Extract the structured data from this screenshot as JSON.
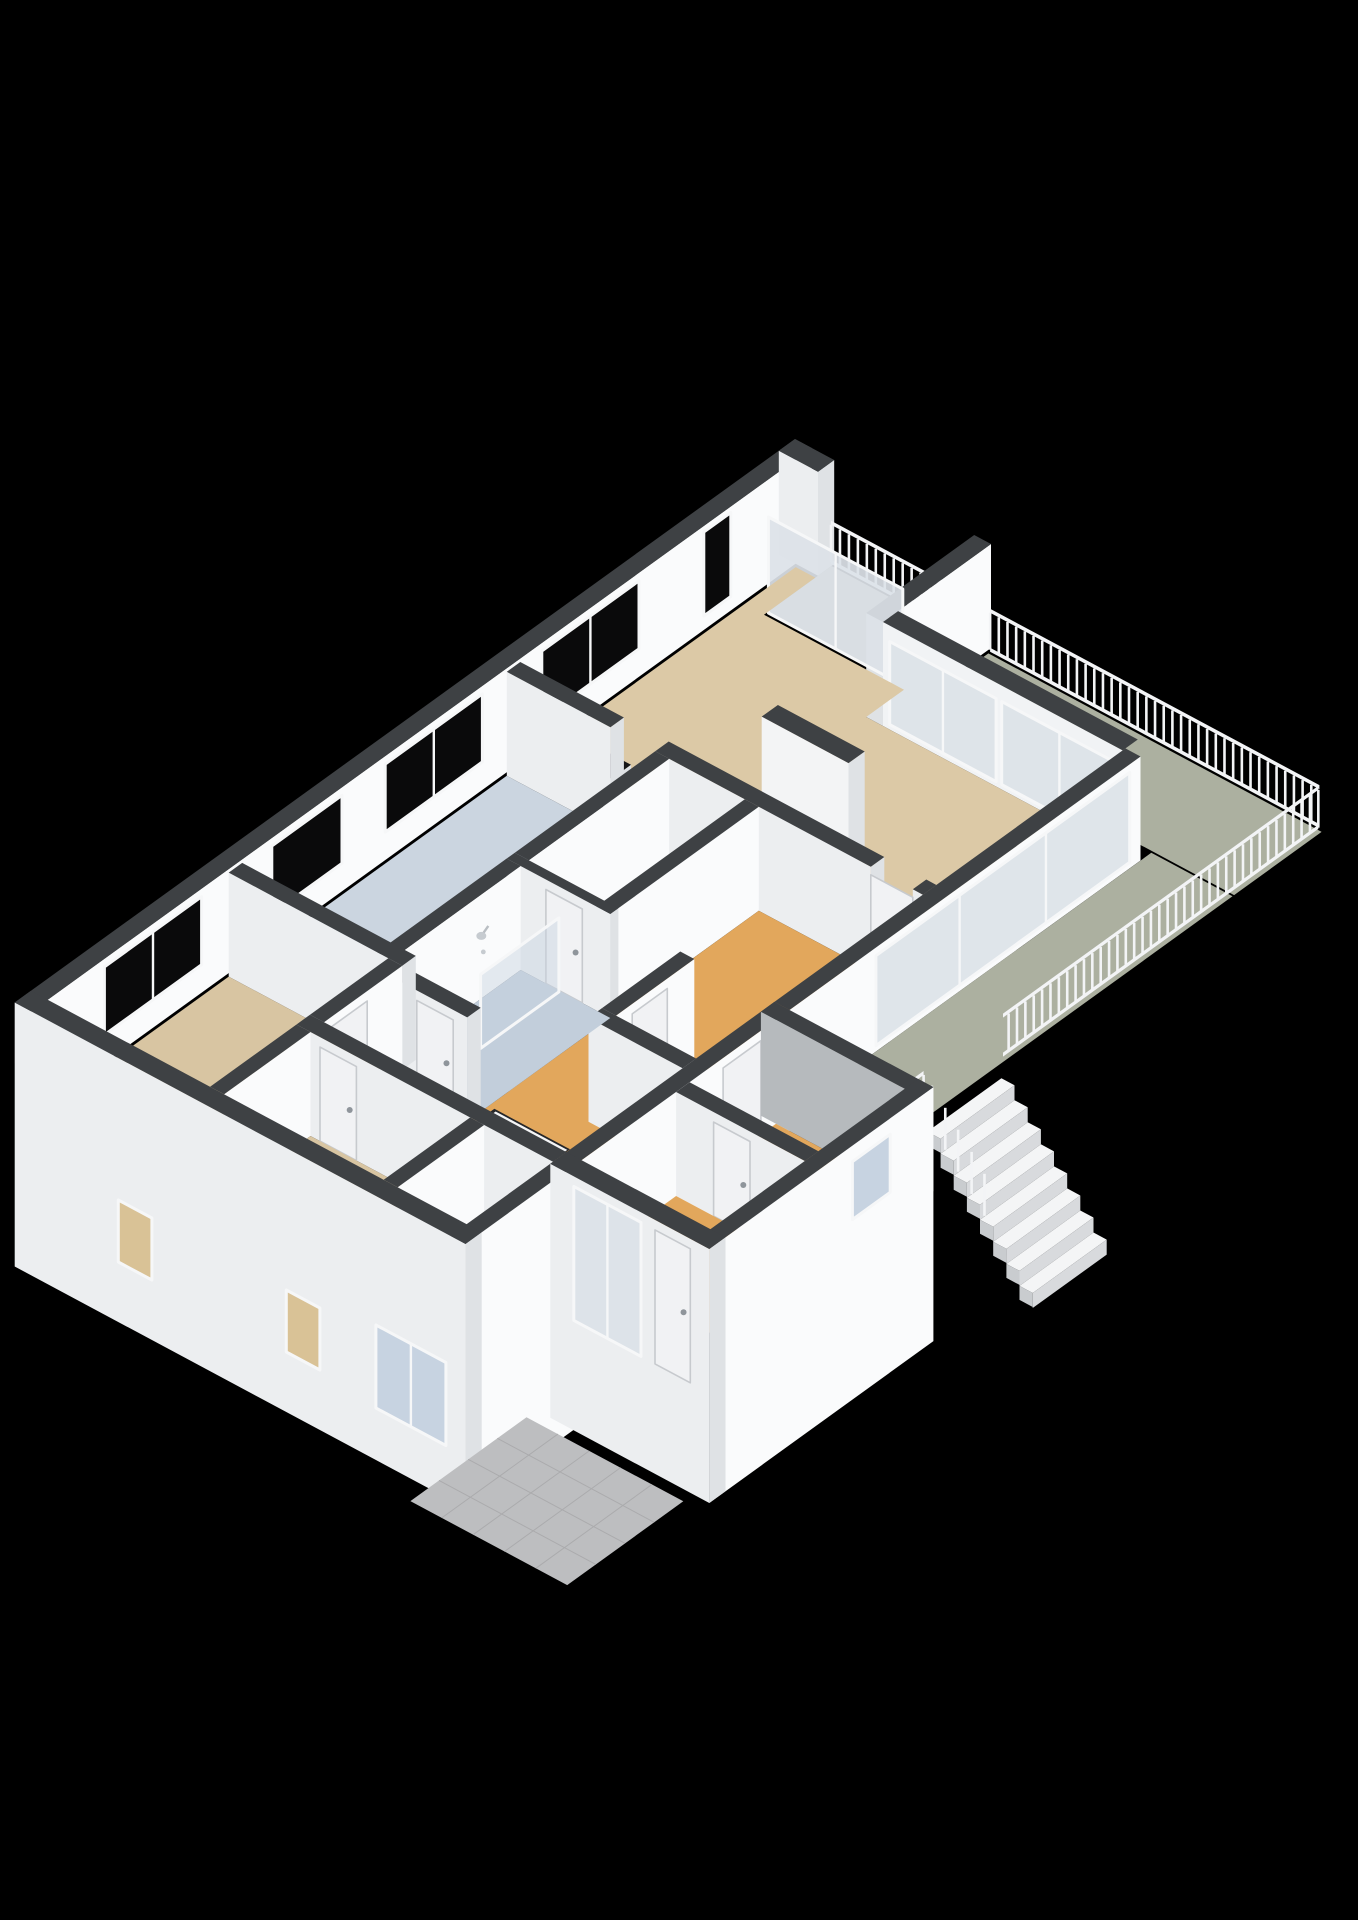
{
  "view": {
    "title": "3d-floorplan-isometric-view",
    "canvas": {
      "width": 1358,
      "height": 1920,
      "background": "#000000"
    }
  },
  "projection": {
    "ox": 795,
    "oy": 543,
    "ux": 56,
    "uy": 30,
    "vx": -54,
    "vy": 39,
    "wallH": 104,
    "railH": 47
  },
  "palette": {
    "wallTop": "#3e4144",
    "faceSE": "#fafbfc",
    "faceSW": "#eceef0",
    "cap": "#dfe2e5",
    "faceGray": "#b6babd",
    "frame": "#f6f7f8",
    "glassDark": "#0a0a0b",
    "glassPale": "#dce2e8",
    "glassFrost": "#c7d3e1",
    "glassLit": "#d9c296",
    "floorTan": "#dcc9a6",
    "floorTan2": "#d8c5a2",
    "floorOrange": "#e2a75c",
    "floorBlue": "#cbd5e0",
    "floorBath": "#c2cedb",
    "floorPale": "#e8e9eb",
    "floorToilet": "#e2e6ea",
    "terrace": "#acb0a0",
    "balcony": "#b1b5a5",
    "porch": "#bdbec0",
    "porchLine": "#ababad",
    "counterTop": "#161617",
    "cabinet": "#f2f3f4",
    "hob": "#92989e",
    "hobRim": "#c8cdd2",
    "hobCore": "#595e63",
    "stairTread": "#f4f5f6",
    "stairRiser": "#d8dadd",
    "stairSide": "#c9cccf",
    "stairwell": "#26272a",
    "rail": "#f3f4f6",
    "door": "#f1f2f4",
    "doorEdge": "#c7cace",
    "handle": "#8f959b"
  },
  "scene": [
    {
      "t": "wallV",
      "n": "outer-wall-northwest",
      "a1": 0,
      "a2": 0.3,
      "b1": 0,
      "b2": 14.45,
      "face": "#fafbfc"
    },
    {
      "t": "glassV",
      "n": "window-slit-living",
      "a": 0.3,
      "b1": 1.5,
      "b2": 2.0,
      "z1": 14,
      "z2": 98,
      "fill": "#0a0a0b"
    },
    {
      "t": "glassV",
      "n": "window-living-northwest",
      "a": 0.3,
      "b1": 3.2,
      "b2": 5.0,
      "z1": 28,
      "z2": 96,
      "fill": "#0a0a0b",
      "mull": [
        0.5
      ]
    },
    {
      "t": "glassV",
      "n": "window-kitchen-northwest-1",
      "a": 0.3,
      "b1": 6.1,
      "b2": 7.9,
      "z1": 28,
      "z2": 96,
      "fill": "#0a0a0b",
      "mull": [
        0.5
      ]
    },
    {
      "t": "glassV",
      "n": "window-kitchen-northwest-2",
      "a": 0.3,
      "b1": 8.7,
      "b2": 10.0,
      "z1": 28,
      "z2": 96,
      "fill": "#0a0a0b"
    },
    {
      "t": "glassV",
      "n": "window-bedroom1-northwest",
      "a": 0.3,
      "b1": 11.3,
      "b2": 13.1,
      "z1": 28,
      "z2": 96,
      "fill": "#0a0a0b",
      "mull": [
        0.5
      ]
    },
    {
      "t": "wallU",
      "n": "wall-apex-stub",
      "a1": 0,
      "a2": 0.7,
      "b1": 0,
      "b2": 0.3,
      "capA": true
    },
    {
      "t": "floor",
      "n": "balcony-floor",
      "r": [
        0.7,
        0.05,
        3.2,
        1.25
      ],
      "fill": "#b1b5a5"
    },
    {
      "t": "railU",
      "n": "balcony-railing",
      "a1": 0.72,
      "a2": 3.18,
      "b": 0.08,
      "st": 0.16
    },
    {
      "t": "wallV",
      "n": "wall-balcony-divider",
      "a1": 3.2,
      "a2": 3.5,
      "b1": 0,
      "b2": 2.0,
      "capB": true
    },
    {
      "t": "glassU",
      "n": "balcony-sliding-door",
      "b": 1.27,
      "a1": 0.75,
      "a2": 3.15,
      "z1": 2,
      "z2": 98,
      "fill": "#dce2e8",
      "op": 0.92,
      "mull": [
        0.5
      ]
    },
    {
      "t": "floor",
      "n": "terrace-floor-north",
      "r": [
        3.55,
        0.1,
        9.5,
        1.72
      ],
      "fill": "#acb0a0"
    },
    {
      "t": "railU",
      "n": "terrace-railing-northeast",
      "a1": 3.6,
      "a2": 9.48,
      "b": 0.12,
      "st": 0.155
    },
    {
      "t": "wallU",
      "n": "living-glass-wall-frame",
      "a1": 3.5,
      "a2": 7.78,
      "b1": 1.72,
      "b2": 2.0,
      "face": "#f1f3f5",
      "capA": false
    },
    {
      "t": "glassU",
      "n": "living-terrace-slider-1",
      "b": 2.0,
      "a1": 3.62,
      "a2": 5.52,
      "z1": 5,
      "z2": 88,
      "fill": "#dce2e8",
      "op": 0.9,
      "mull": [
        0.5
      ]
    },
    {
      "t": "glassU",
      "n": "living-terrace-slider-2",
      "b": 2.0,
      "a1": 5.62,
      "a2": 7.68,
      "z1": 5,
      "z2": 88,
      "fill": "#dce2e8",
      "op": 0.9,
      "mull": [
        0.5
      ]
    },
    {
      "t": "floor",
      "n": "living-room-floor",
      "poly": [
        [
          0.35,
          0.35
        ],
        [
          0.7,
          0.35
        ],
        [
          0.7,
          1.3
        ],
        [
          3.2,
          1.3
        ],
        [
          3.2,
          2.0
        ],
        [
          7.78,
          2.0
        ],
        [
          7.78,
          5.45
        ],
        [
          0.35,
          5.45
        ]
      ],
      "fill": "#dcc9a6"
    },
    {
      "t": "wallU",
      "n": "chimney-wall",
      "a1": 3.6,
      "a2": 5.15,
      "b1": 4.05,
      "b2": 4.35,
      "face": "#f3f4f5",
      "capA": true
    },
    {
      "t": "wallU",
      "n": "sideboard-counter",
      "a1": 0.5,
      "a2": 1.95,
      "b1": 5.06,
      "b2": 5.42,
      "h": 34,
      "top": "#161617",
      "face": "#f2f3f4",
      "capA": true
    },
    {
      "t": "wallU",
      "n": "wall-living-south-west",
      "a1": 0.35,
      "a2": 2.2,
      "b1": 5.45,
      "b2": 5.7,
      "capA": true
    },
    {
      "t": "wallU",
      "n": "wall-living-south-east",
      "a1": 3.0,
      "a2": 6.85,
      "b1": 5.45,
      "b2": 5.7,
      "capA": true
    },
    {
      "t": "wallU",
      "n": "wall-living-south-jamb",
      "a1": 7.6,
      "a2": 7.78,
      "b1": 5.45,
      "b2": 5.7
    },
    {
      "t": "doorU",
      "n": "door-hall-living",
      "b": 5.7,
      "a1": 6.85,
      "a2": 7.6,
      "z1": 0,
      "z2": 96
    },
    {
      "t": "floor",
      "n": "kitchen-floor",
      "r": [
        0.35,
        5.7,
        3.0,
        10.6
      ],
      "fill": "#cbd5e0"
    },
    {
      "t": "wallV",
      "n": "kitchen-island",
      "a1": 2.3,
      "a2": 2.95,
      "b1": 5.95,
      "b2": 10.2,
      "h": 38,
      "top": "#161617",
      "face": "#f2f3f4",
      "capB": true
    },
    {
      "t": "hob",
      "n": "gas-hob-1",
      "a1": 2.36,
      "a2": 2.9,
      "b1": 7.12,
      "b2": 7.78,
      "z": 38
    },
    {
      "t": "hob",
      "n": "gas-hob-2",
      "a1": 2.36,
      "a2": 2.9,
      "b1": 7.92,
      "b2": 8.58,
      "z": 38
    },
    {
      "t": "wallV",
      "n": "wall-kitchen-closet",
      "a1": 3.0,
      "a2": 3.25,
      "b1": 5.7,
      "b2": 8.3,
      "capB": true
    },
    {
      "t": "floor",
      "n": "closet-floor",
      "r": [
        3.25,
        5.7,
        4.6,
        8.3
      ],
      "fill": "#e8e9eb"
    },
    {
      "t": "wallV",
      "n": "wall-closet-hall",
      "a1": 4.6,
      "a2": 4.85,
      "b1": 5.7,
      "b2": 8.45,
      "capB": true
    },
    {
      "t": "floor",
      "n": "hallway-floor",
      "r": [
        4.85,
        5.7,
        7.78,
        12.3
      ],
      "fill": "#e2a75c"
    },
    {
      "t": "wallU",
      "n": "wall-bathroom-north",
      "a1": 3.0,
      "a2": 4.85,
      "b1": 8.3,
      "b2": 8.45,
      "capA": true
    },
    {
      "t": "doorU",
      "n": "door-closet",
      "b": 8.45,
      "a1": 3.7,
      "a2": 4.35,
      "z1": 0,
      "z2": 94
    },
    {
      "t": "wallV",
      "n": "wall-toilet-west",
      "a1": 6.1,
      "a2": 6.35,
      "b1": 8.45,
      "b2": 9.9,
      "capB": true
    },
    {
      "t": "floor",
      "n": "toilet-floor",
      "r": [
        6.35,
        8.45,
        7.78,
        9.9
      ],
      "fill": "#e2e6ea"
    },
    {
      "t": "doorV",
      "n": "door-toilet",
      "a": 6.35,
      "b1": 8.95,
      "b2": 9.6,
      "z1": 0,
      "z2": 94
    },
    {
      "t": "wallU",
      "n": "wall-toilet-south",
      "a1": 6.1,
      "a2": 7.78,
      "b1": 9.9,
      "b2": 10.15
    },
    {
      "t": "wallV",
      "n": "wall-bathroom-west",
      "a1": 3.0,
      "a2": 3.25,
      "b1": 8.45,
      "b2": 10.85,
      "capB": true
    },
    {
      "t": "floor",
      "n": "bathroom-floor",
      "r": [
        3.25,
        8.45,
        4.85,
        10.85
      ],
      "fill": "#c2cedb"
    },
    {
      "t": "glassV",
      "n": "shower-glass-screen",
      "a": 3.98,
      "b1": 8.5,
      "b2": 9.95,
      "z1": 2,
      "z2": 76,
      "fill": "#c7d3e1",
      "op": 0.45
    },
    {
      "t": "shower",
      "n": "shower-head",
      "a": 3.27,
      "b": 9.2,
      "z": 64
    },
    {
      "t": "wallU",
      "n": "wall-bathroom-south",
      "a1": 3.2,
      "a2": 4.85,
      "b1": 10.85,
      "b2": 11.1,
      "capA": true
    },
    {
      "t": "doorU",
      "n": "door-bathroom",
      "b": 11.1,
      "a1": 3.95,
      "a2": 4.6,
      "z1": 0,
      "z2": 94
    },
    {
      "t": "floor",
      "n": "corridor-floor",
      "r": [
        3.2,
        11.1,
        4.85,
        12.3
      ],
      "fill": "#e2a75c"
    },
    {
      "t": "floor",
      "n": "stairwell-opening",
      "r": [
        4.95,
        10.7,
        6.3,
        12.3
      ],
      "fill": "#26272a"
    },
    {
      "t": "stairsV",
      "n": 6,
      "a1": 5.0,
      "a2": 6.28,
      "b0": 10.73,
      "td": 0.26,
      "drop": 13
    },
    {
      "t": "wallU",
      "n": "wall-kitchen-bedroom1",
      "a1": 0.35,
      "a2": 3.45,
      "b1": 10.6,
      "b2": 10.85,
      "capA": true
    },
    {
      "t": "wallV",
      "n": "wall-bedroom1-northeast",
      "a1": 3.2,
      "a2": 3.45,
      "b1": 10.85,
      "b2": 12.3,
      "capB": true
    },
    {
      "t": "doorV",
      "n": "door-bedroom1",
      "a": 3.45,
      "b1": 11.5,
      "b2": 12.15,
      "z1": 0,
      "z2": 94
    },
    {
      "t": "floor",
      "n": "bedroom1-floor",
      "r": [
        0.35,
        10.85,
        3.2,
        14.15
      ],
      "fill": "#d8c5a2"
    },
    {
      "t": "wallU",
      "n": "wall-bedroom2-north",
      "a1": 3.2,
      "a2": 7.78,
      "b1": 12.3,
      "b2": 12.55,
      "capA": true
    },
    {
      "t": "doorU",
      "n": "door-bedroom2",
      "b": 12.55,
      "a1": 3.62,
      "a2": 4.27,
      "z1": 0,
      "z2": 94
    },
    {
      "t": "wallV",
      "n": "wall-bedroom1-bedroom2",
      "a1": 3.2,
      "a2": 3.45,
      "b1": 12.55,
      "b2": 14.15
    },
    {
      "t": "floor",
      "n": "bedroom2-floor",
      "r": [
        3.45,
        12.55,
        6.3,
        14.15
      ],
      "fill": "#d8c5a2"
    },
    {
      "t": "wallV",
      "n": "wall-bedroom2-nook",
      "a1": 6.3,
      "a2": 6.55,
      "b1": 12.55,
      "b2": 14.15
    },
    {
      "t": "floor",
      "n": "nook-floor",
      "r": [
        6.55,
        12.55,
        7.78,
        14.15
      ],
      "fill": "#e8e9eb"
    },
    {
      "t": "wallV",
      "n": "outer-wall-southeast-north",
      "a1": 7.78,
      "a2": 8.05,
      "b1": 1.95,
      "b2": 8.45
    },
    {
      "t": "glassV",
      "n": "hall-terrace-window-wall",
      "a": 8.05,
      "b1": 2.15,
      "b2": 6.85,
      "z1": 6,
      "z2": 96,
      "fill": "#dce2e8",
      "op": 0.9,
      "mull": [
        0.33,
        0.67
      ]
    },
    {
      "t": "floor",
      "n": "terrace-floor-east",
      "r": [
        8.05,
        1.75,
        9.5,
        8.45
      ],
      "fill": "#acb0a0"
    },
    {
      "t": "railV",
      "n": "terrace-railing-southeast",
      "a": 9.48,
      "b1": 0.14,
      "b2": 5.98,
      "st": 0.155
    },
    {
      "t": "stairsU",
      "n": 8,
      "a0": 9.5,
      "b1": 6.03,
      "b2": 7.4,
      "td": 0.235,
      "drop": 15
    },
    {
      "t": "posts",
      "n": "stair-railing-posts",
      "pts": [
        [
          9.56,
          7.38,
          -10,
          42
        ],
        [
          9.8,
          7.38,
          -25,
          42
        ],
        [
          10.03,
          7.38,
          -40,
          42
        ],
        [
          10.27,
          7.38,
          -55,
          42
        ],
        [
          10.5,
          7.38,
          -70,
          42
        ]
      ]
    },
    {
      "t": "railV",
      "n": "terrace-railing-southwest-stub",
      "a": 9.48,
      "b1": 7.45,
      "b2": 8.42,
      "st": 0.155
    },
    {
      "t": "wallV",
      "n": "outer-wall-southeast-south",
      "a1": 7.78,
      "a2": 8.05,
      "b1": 8.45,
      "b2": 14.45,
      "skirt": 160
    },
    {
      "t": "doorV",
      "n": "door-hall-vestibule",
      "a": 8.05,
      "b1": 8.98,
      "b2": 9.68,
      "z1": 0,
      "z2": 94
    },
    {
      "t": "wallU",
      "n": "wall-annex-northeast",
      "a1": 7.78,
      "a2": 10.62,
      "b1": 8.45,
      "b2": 8.7,
      "face": "#b6babd",
      "capA": true
    },
    {
      "t": "floor",
      "n": "vestibule-floor",
      "r": [
        8.05,
        8.7,
        10.35,
        10.3
      ],
      "fill": "#e2a75c"
    },
    {
      "t": "wallU",
      "n": "wall-annex-middle",
      "a1": 8.05,
      "a2": 10.35,
      "b1": 10.3,
      "b2": 10.55,
      "capA": true
    },
    {
      "t": "doorU",
      "n": "door-vestibule-entry",
      "b": 10.55,
      "a1": 8.72,
      "a2": 9.37,
      "z1": 0,
      "z2": 94
    },
    {
      "t": "floor",
      "n": "entry-room-floor",
      "r": [
        8.05,
        10.55,
        10.35,
        12.3
      ],
      "fill": "#e2a75c"
    },
    {
      "t": "wallV",
      "n": "wall-annex-southeast",
      "a1": 10.35,
      "a2": 10.62,
      "b1": 8.45,
      "b2": 12.6,
      "skirt": 150
    },
    {
      "t": "glassV",
      "n": "window-annex-southeast",
      "a": 10.62,
      "b1": 9.25,
      "b2": 9.95,
      "z1": 30,
      "z2": 88,
      "fill": "#c7d3e1"
    },
    {
      "t": "wallU",
      "n": "wall-annex-southwest",
      "a1": 7.78,
      "a2": 10.62,
      "b1": 12.3,
      "b2": 12.6,
      "skirt": 150,
      "capA": true
    },
    {
      "t": "glassU",
      "n": "entry-sliding-door",
      "b": 12.6,
      "a1": 8.2,
      "a2": 9.4,
      "z1": -40,
      "z2": 94,
      "fill": "#dce2e8",
      "op": 0.95,
      "mull": [
        0.5
      ]
    },
    {
      "t": "doorU",
      "n": "front-door",
      "b": 12.6,
      "a1": 9.65,
      "a2": 10.28,
      "z1": -40,
      "z2": 94
    },
    {
      "t": "wallU",
      "n": "outer-wall-southwest",
      "a1": 0,
      "a2": 8.05,
      "b1": 14.15,
      "b2": 14.45,
      "skirt": 160,
      "capA": true
    },
    {
      "t": "glassU",
      "n": "ground-floor-window-1",
      "b": 14.45,
      "a1": 1.85,
      "a2": 2.45,
      "z1": -100,
      "z2": -38,
      "fill": "#d9c296"
    },
    {
      "t": "glassU",
      "n": "ground-floor-window-2",
      "b": 14.45,
      "a1": 4.85,
      "a2": 5.45,
      "z1": -100,
      "z2": -38,
      "fill": "#d9c296"
    },
    {
      "t": "glassU",
      "n": "ground-floor-window-bathroom",
      "b": 14.45,
      "a1": 6.45,
      "a2": 7.7,
      "z1": -108,
      "z2": -25,
      "fill": "#c7d3e1",
      "mull": [
        0.5
      ]
    },
    {
      "t": "porch",
      "n": "entrance-porch-tiles",
      "r": [
        7.5,
        12.75,
        10.3,
        14.9
      ],
      "z": -152,
      "stepA": 0.56,
      "stepB": 0.54
    }
  ]
}
